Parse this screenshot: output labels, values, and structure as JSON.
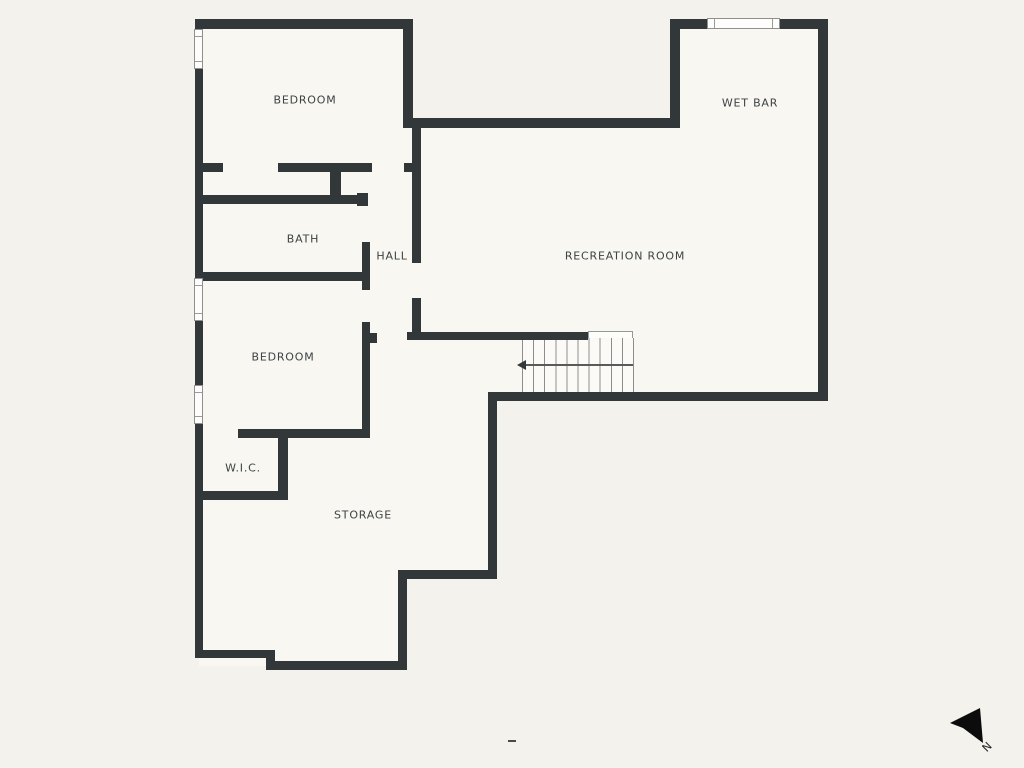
{
  "rooms": {
    "bedroom_top": "BEDROOM",
    "wet_bar": "WET BAR",
    "bath": "BATH",
    "hall": "HALL",
    "recreation_room": "RECREATION ROOM",
    "bedroom_left": "BEDROOM",
    "wic": "W.I.C.",
    "storage": "STORAGE"
  },
  "compass": {
    "north_label": "N"
  },
  "colors": {
    "wall": "#323839",
    "background": "#f3f2ec",
    "floor": "#f8f7f2",
    "label_text": "#3d4245",
    "compass_arrow": "#0c0c0c"
  }
}
